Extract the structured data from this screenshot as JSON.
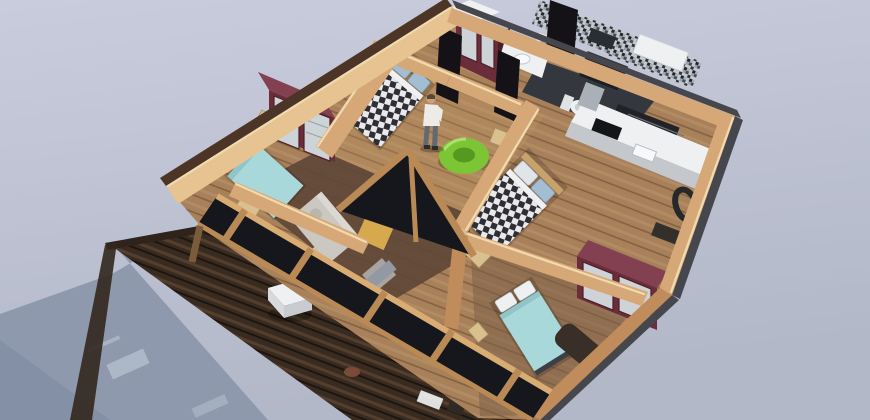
{
  "scene": {
    "title": "3D cutaway floor plan render of a wooden cabin viewed from above",
    "rooms": [
      "bedroom-top",
      "bedroom-left",
      "bedroom-center",
      "bedroom-bottom-right",
      "bathroom",
      "kitchen",
      "living-room",
      "hallway",
      "deck"
    ],
    "objects": [
      "checkered-double-bed",
      "checkered-double-bed-2",
      "teal-bed",
      "teal-bed-2",
      "maroon-wardrobe",
      "maroon-wardrobe-2",
      "maroon-hall-wardrobe",
      "green-beanbag",
      "green-beanbag-2",
      "standing-person",
      "kitchen-counter",
      "bathroom-toilet",
      "shower",
      "sofa",
      "coffee-table",
      "wood-deck",
      "deck-table",
      "window-facade",
      "ground-shadow"
    ]
  },
  "colors": {
    "bg_top": "#c9ccdc",
    "bg_bottom": "#b2b8c8",
    "shadow": "#8e99ad",
    "shadow_deep": "#8390a6",
    "shadow_streak": "#b1bdca",
    "wood_face": "#d6a877",
    "wood_face_light": "#e7c globalement91",
    "wood_dim": "#c08c5c",
    "wood_top": "#f0dab0",
    "rim_brown": "#4c3526",
    "rim_gray": "#46474d",
    "floor_base": "#a8815a",
    "floor_dark": "#5f4736",
    "bath_floor": "#35373e",
    "deck_base": "#3a2b20",
    "maroon": "#6b2d3a",
    "maroon_top": "#824051",
    "maroon_dark": "#4a1f28",
    "door_slat": "#ced3d7",
    "teal": "#a9d8da",
    "teal_shade": "#8fc6ca",
    "beige": "#d9c08f",
    "pillow_blue": "#a3bdd2",
    "checker_dark": "#2e2e34",
    "checker_light": "#e9e9ec",
    "green": "#7cc636",
    "green_dark": "#55991f",
    "green_hi": "#b9e87e",
    "glass": "#15171c",
    "wood_mullion": "#b98a55",
    "wood_mullion_light": "#d9ac74",
    "white": "#eef0f2",
    "steel": "#aab0b7",
    "sofa": "#cbc8c1",
    "sofa_light": "#dbd8d1",
    "mustard": "#d7a94f",
    "gray_throw": "#9399a2",
    "skin": "#c9a287",
    "shirt": "#ecebe6",
    "pants": "#636973",
    "desk": "#3a2f28",
    "appliance": "#202227"
  }
}
